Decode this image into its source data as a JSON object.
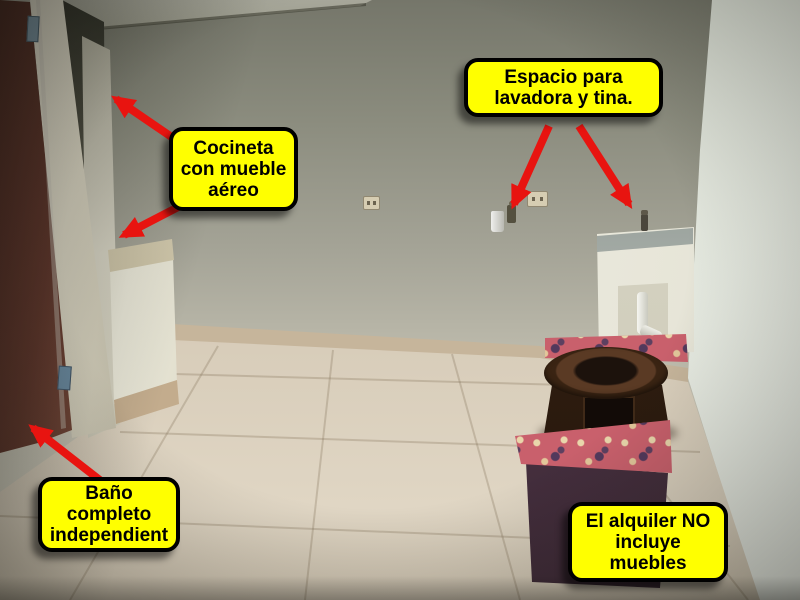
{
  "scene": {
    "type": "annotated-photo",
    "subject": "Empty apartment interior advertised for rent with feature callouts"
  },
  "callouts": [
    {
      "id": "laundry-space",
      "label": "Espacio para\nlavadora y tina."
    },
    {
      "id": "kitchenette",
      "label": "Cocineta\ncon mueble\naéreo"
    },
    {
      "id": "bathroom",
      "label": "Baño\ncompleto\nindependient"
    },
    {
      "id": "furniture-notice",
      "label": "El alquiler NO\nincluye\nmuebles"
    }
  ],
  "colors": {
    "callout_bg": "#ffff00",
    "callout_text": "#000000",
    "callout_border": "#000000",
    "arrow_red": "#e81410",
    "wall_top": "#75766a",
    "wall_bottom": "#dbd8c9",
    "right_wall": "#e8ece3",
    "floor_far": "#b3a693",
    "floor_near": "#e0d6c4",
    "door_brown": "#63392e",
    "counter_top": "#e0d9c0",
    "sink_white": "#ecebdf",
    "table_wood": "#3a2413",
    "ottoman_floral": "#c9606c",
    "ottoman_body": "#4b3344"
  }
}
